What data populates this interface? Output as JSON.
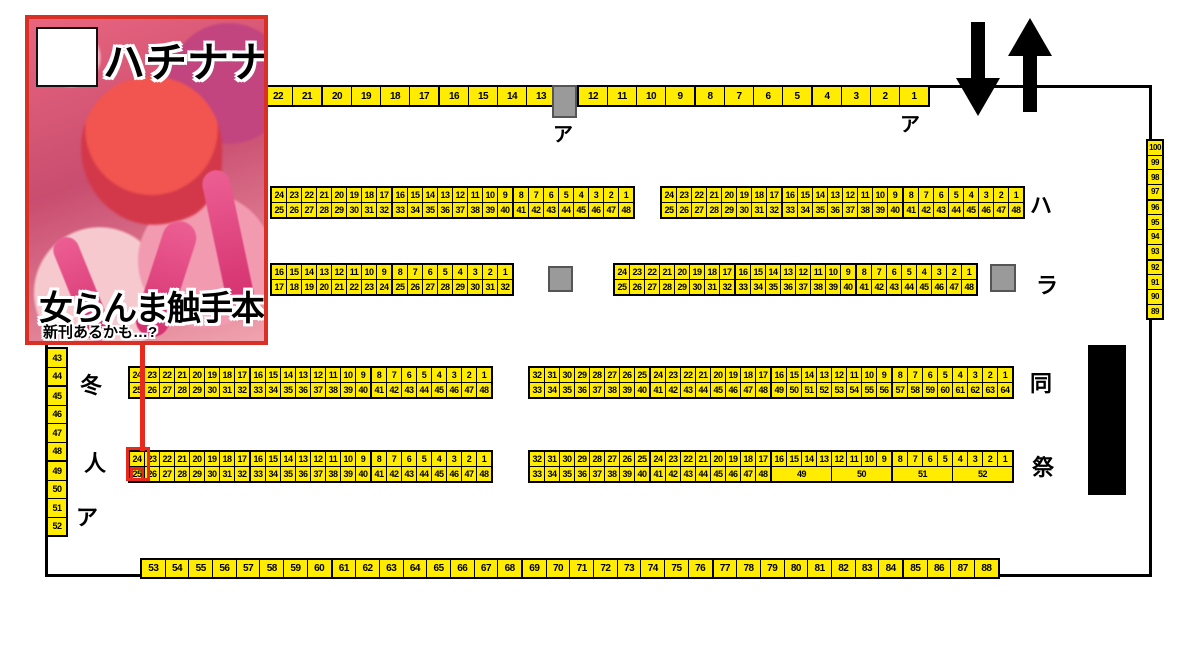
{
  "cover": {
    "circle_name": "ハチナナ",
    "book_title": "女らんま触手本",
    "subtitle": "新刊あるかも…?"
  },
  "labels": {
    "top_block": "ア",
    "top_right": "ア",
    "row_ha": "ハ",
    "row_ra": "ラ",
    "row_dou": "同",
    "row_sai": "祭",
    "left_fuyu": "冬",
    "left_hito": "人",
    "left_a": "ア"
  },
  "colors": {
    "seat_yellow": "#ffec00",
    "highlight_red": "#e8291c",
    "cover_border": "#d93025",
    "gray_block": "#9a9a9a"
  },
  "seating": {
    "a1": [
      [
        [
          "22",
          "21"
        ],
        [
          "20",
          "19",
          "18",
          "17"
        ],
        [
          "16",
          "15",
          "14",
          "13"
        ]
      ]
    ],
    "a2": [
      [
        [
          "12",
          "11",
          "10",
          "9"
        ],
        [
          "8",
          "7",
          "6",
          "5"
        ],
        [
          "4",
          "3",
          "2",
          "1"
        ]
      ]
    ],
    "ha_left": [
      [
        [
          "24",
          "23",
          "22",
          "21",
          "20",
          "19",
          "18",
          "17"
        ],
        [
          "16",
          "15",
          "14",
          "13",
          "12",
          "11",
          "10",
          "9"
        ],
        [
          "8",
          "7",
          "6",
          "5",
          "4",
          "3",
          "2",
          "1"
        ]
      ],
      [
        [
          "25",
          "26",
          "27",
          "28",
          "29",
          "30",
          "31",
          "32"
        ],
        [
          "33",
          "34",
          "35",
          "36",
          "37",
          "38",
          "39",
          "40"
        ],
        [
          "41",
          "42",
          "43",
          "44",
          "45",
          "46",
          "47",
          "48"
        ]
      ]
    ],
    "ha_right": [
      [
        [
          "24",
          "23",
          "22",
          "21",
          "20",
          "19",
          "18",
          "17"
        ],
        [
          "16",
          "15",
          "14",
          "13",
          "12",
          "11",
          "10",
          "9"
        ],
        [
          "8",
          "7",
          "6",
          "5",
          "4",
          "3",
          "2",
          "1"
        ]
      ],
      [
        [
          "25",
          "26",
          "27",
          "28",
          "29",
          "30",
          "31",
          "32"
        ],
        [
          "33",
          "34",
          "35",
          "36",
          "37",
          "38",
          "39",
          "40"
        ],
        [
          "41",
          "42",
          "43",
          "44",
          "45",
          "46",
          "47",
          "48"
        ]
      ]
    ],
    "ra_left": [
      [
        [
          "16",
          "15",
          "14",
          "13",
          "12",
          "11",
          "10",
          "9"
        ],
        [
          "8",
          "7",
          "6",
          "5",
          "4",
          "3",
          "2",
          "1"
        ]
      ],
      [
        [
          "17",
          "18",
          "19",
          "20",
          "21",
          "22",
          "23",
          "24"
        ],
        [
          "25",
          "26",
          "27",
          "28",
          "29",
          "30",
          "31",
          "32"
        ]
      ]
    ],
    "ra_right": [
      [
        [
          "24",
          "23",
          "22",
          "21",
          "20",
          "19",
          "18",
          "17"
        ],
        [
          "16",
          "15",
          "14",
          "13",
          "12",
          "11",
          "10",
          "9"
        ],
        [
          "8",
          "7",
          "6",
          "5",
          "4",
          "3",
          "2",
          "1"
        ]
      ],
      [
        [
          "25",
          "26",
          "27",
          "28",
          "29",
          "30",
          "31",
          "32"
        ],
        [
          "33",
          "34",
          "35",
          "36",
          "37",
          "38",
          "39",
          "40"
        ],
        [
          "41",
          "42",
          "43",
          "44",
          "45",
          "46",
          "47",
          "48"
        ]
      ]
    ],
    "dou_left": [
      [
        [
          "24",
          "23",
          "22",
          "21",
          "20",
          "19",
          "18",
          "17"
        ],
        [
          "16",
          "15",
          "14",
          "13",
          "12",
          "11",
          "10",
          "9"
        ],
        [
          "8",
          "7",
          "6",
          "5",
          "4",
          "3",
          "2",
          "1"
        ]
      ],
      [
        [
          "25",
          "26",
          "27",
          "28",
          "29",
          "30",
          "31",
          "32"
        ],
        [
          "33",
          "34",
          "35",
          "36",
          "37",
          "38",
          "39",
          "40"
        ],
        [
          "41",
          "42",
          "43",
          "44",
          "45",
          "46",
          "47",
          "48"
        ]
      ]
    ],
    "dou_right": [
      [
        [
          "32",
          "31",
          "30",
          "29",
          "28",
          "27",
          "26",
          "25"
        ],
        [
          "24",
          "23",
          "22",
          "21",
          "20",
          "19",
          "18",
          "17"
        ],
        [
          "16",
          "15",
          "14",
          "13",
          "12",
          "11",
          "10",
          "9"
        ],
        [
          "8",
          "7",
          "6",
          "5",
          "4",
          "3",
          "2",
          "1"
        ]
      ],
      [
        [
          "33",
          "34",
          "35",
          "36",
          "37",
          "38",
          "39",
          "40"
        ],
        [
          "41",
          "42",
          "43",
          "44",
          "45",
          "46",
          "47",
          "48"
        ],
        [
          "49",
          "50",
          "51",
          "52",
          "53",
          "54",
          "55",
          "56"
        ],
        [
          "57",
          "58",
          "59",
          "60",
          "61",
          "62",
          "63",
          "64"
        ]
      ]
    ],
    "sai_left": [
      [
        [
          "24",
          "23",
          "22",
          "21",
          "20",
          "19",
          "18",
          "17"
        ],
        [
          "16",
          "15",
          "14",
          "13",
          "12",
          "11",
          "10",
          "9"
        ],
        [
          "8",
          "7",
          "6",
          "5",
          "4",
          "3",
          "2",
          "1"
        ]
      ],
      [
        [
          {
            "t": "25",
            "hl": true
          },
          "26",
          "27",
          "28",
          "29",
          "30",
          "31",
          "32"
        ],
        [
          "33",
          "34",
          "35",
          "36",
          "37",
          "38",
          "39",
          "40"
        ],
        [
          "41",
          "42",
          "43",
          "44",
          "45",
          "46",
          "47",
          "48"
        ]
      ]
    ],
    "sai_right": [
      [
        [
          "32",
          "31",
          "30",
          "29",
          "28",
          "27",
          "26",
          "25"
        ],
        [
          "24",
          "23",
          "22",
          "21",
          "20",
          "19",
          "18",
          "17"
        ],
        [
          "16",
          "15",
          "14",
          "13",
          "12",
          "11",
          "10",
          "9"
        ],
        [
          "8",
          "7",
          "6",
          "5",
          "4",
          "3",
          "2",
          "1"
        ]
      ],
      [
        [
          "33",
          "34",
          "35",
          "36",
          "37",
          "38",
          "39",
          "40"
        ],
        [
          "41",
          "42",
          "43",
          "44",
          "45",
          "46",
          "47",
          "48"
        ],
        [
          {
            "t": "49",
            "w": 4
          },
          {
            "t": "50",
            "w": 4
          }
        ],
        [
          {
            "t": "51",
            "w": 4
          },
          {
            "t": "52",
            "w": 4
          }
        ]
      ]
    ],
    "bottom": [
      [
        [
          "53",
          "54",
          "55",
          "56",
          "57",
          "58",
          "59",
          "60"
        ],
        [
          "61",
          "62",
          "63",
          "64",
          "65",
          "66",
          "67",
          "68"
        ],
        [
          "69",
          "70",
          "71",
          "72",
          "73",
          "74",
          "75",
          "76"
        ],
        [
          "77",
          "78",
          "79",
          "80",
          "81",
          "82",
          "83",
          "84"
        ],
        [
          "85",
          "86",
          "87",
          "88"
        ]
      ]
    ],
    "left_col": [
      [
        "43",
        "44"
      ],
      [
        "45",
        "46",
        "47",
        "48"
      ],
      [
        "49",
        "50",
        "51",
        "52"
      ]
    ],
    "right_col": [
      [
        "100",
        "99",
        "98",
        "97"
      ],
      [
        "96",
        "95",
        "94",
        "93"
      ],
      [
        "92",
        "91",
        "90",
        "89"
      ]
    ]
  }
}
